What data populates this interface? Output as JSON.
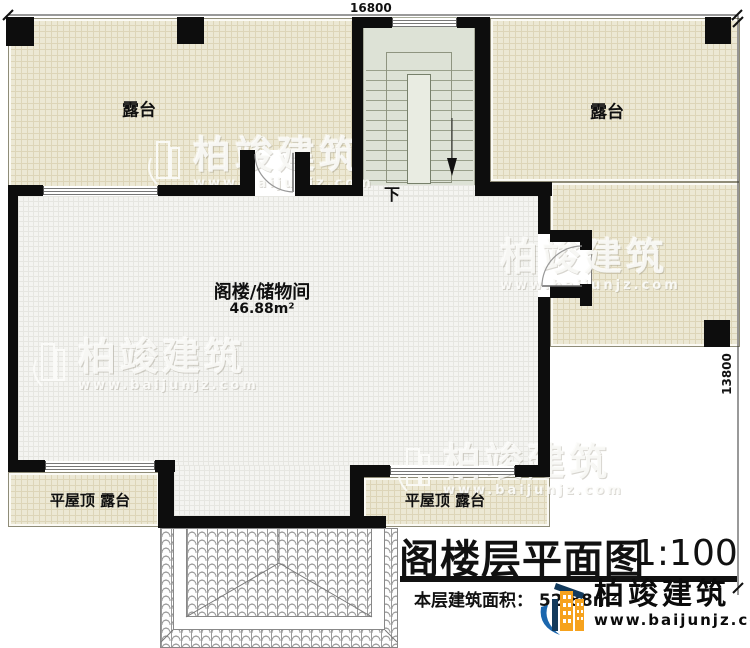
{
  "plan": {
    "dim_top": "16800",
    "dim_right": "13800",
    "terrace_top_left": "露台",
    "terrace_top_right": "露台",
    "attic_name": "阁楼/储物间",
    "attic_area": "46.88m²",
    "stair_down": "下",
    "flat_roof_left": "平屋顶 露台",
    "flat_roof_center": "平屋顶 露台"
  },
  "titleblock": {
    "title": "阁楼层平面图",
    "scale": "1:100",
    "area_label": "本层建筑面积：",
    "area_value": "52.88m²"
  },
  "branding": {
    "name": "柏竣建筑",
    "url": "www.baijunjz.com",
    "watermark_name": "柏竣建筑",
    "watermark_url": "www.baijunjz.com"
  },
  "colors": {
    "terrace_fill": "#ece8d4",
    "floor_fill": "#f4f4f1",
    "stair_fill": "#dde2d6",
    "wall": "#0d0d0d",
    "logo_blue": "#1b67ae",
    "logo_orange": "#f6a21d",
    "logo_navy": "#123a5c"
  }
}
